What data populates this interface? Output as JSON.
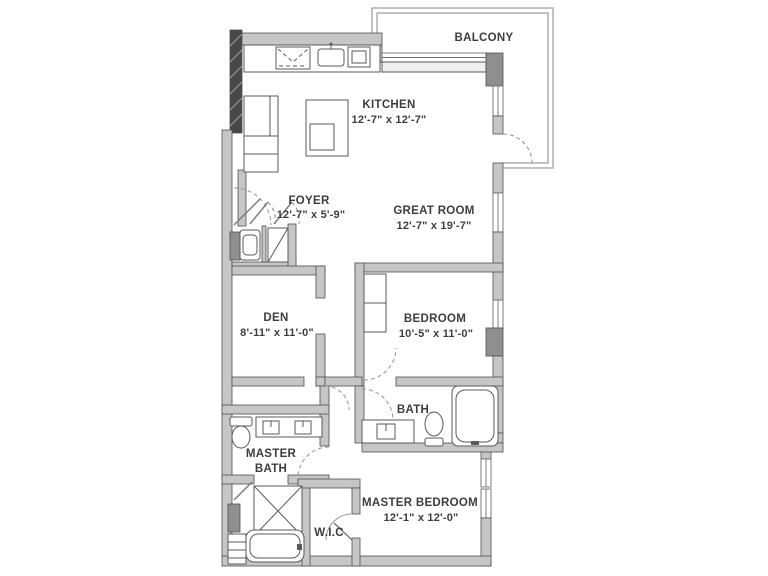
{
  "plan": {
    "balcony_label": "BALCONY",
    "rooms": {
      "kitchen": {
        "name": "KITCHEN",
        "dims": "12'-7\" x 12'-7\""
      },
      "foyer": {
        "name": "FOYER",
        "dims": "12'-7\" x 5'-9\""
      },
      "great_room": {
        "name": "GREAT ROOM",
        "dims": "12'-7\" x 19'-7\""
      },
      "den": {
        "name": "DEN",
        "dims": "8'-11\" x 11'-0\""
      },
      "bedroom": {
        "name": "BEDROOM",
        "dims": "10'-5\" x 11'-0\""
      },
      "bath": {
        "name": "BATH"
      },
      "master_bath": {
        "line1": "MASTER",
        "line2": "BATH"
      },
      "wic": {
        "name": "W.I.C"
      },
      "master_bedroom": {
        "name": "MASTER BEDROOM",
        "dims": "12'-1\" x 12'-0\""
      }
    },
    "colors": {
      "wall_fill": "#c6c6c6",
      "wall_dark": "#8f8f8f",
      "party_wall": "#484848",
      "line": "#4f4f4f",
      "text": "#3d3d3d"
    }
  }
}
